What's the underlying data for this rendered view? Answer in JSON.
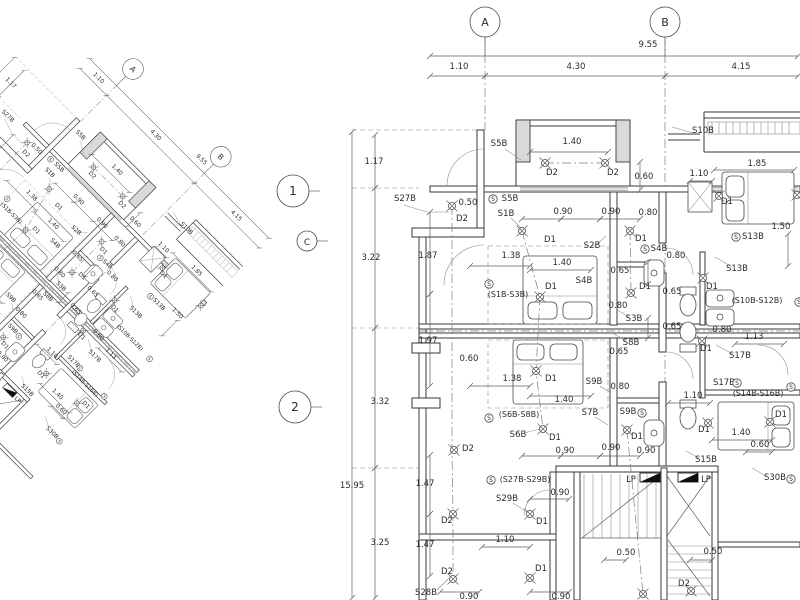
{
  "sheet": {
    "background": "#ffffff",
    "line_color": "#3a3a3a",
    "thin_color": "#8e8e8e",
    "text_color": "#2b2b2b",
    "panel_fill": "#0e0e0e"
  },
  "grid_bubbles": [
    {
      "label": "A",
      "x": 485,
      "y": 22,
      "r": 15
    },
    {
      "label": "B",
      "x": 665,
      "y": 22,
      "r": 15
    }
  ],
  "row_bubbles": [
    {
      "label": "1",
      "x": 293,
      "y": 191,
      "r": 16
    },
    {
      "label": "C",
      "x": 307,
      "y": 241,
      "r": 10
    },
    {
      "label": "2",
      "x": 295,
      "y": 407,
      "r": 16
    }
  ],
  "annotations": [
    {
      "t": "9.55",
      "x": 648,
      "y": 47
    },
    {
      "t": "1.10",
      "x": 459,
      "y": 69
    },
    {
      "t": "4.30",
      "x": 576,
      "y": 69
    },
    {
      "t": "4.15",
      "x": 741,
      "y": 69
    },
    {
      "t": "1.17",
      "x": 374,
      "y": 164
    },
    {
      "t": "3.22",
      "x": 371,
      "y": 260
    },
    {
      "t": "3.32",
      "x": 380,
      "y": 404
    },
    {
      "t": "15.95",
      "x": 352,
      "y": 488
    },
    {
      "t": "3.25",
      "x": 380,
      "y": 545
    },
    {
      "t": "1.87",
      "x": 428,
      "y": 258
    },
    {
      "t": "1.97",
      "x": 428,
      "y": 343
    },
    {
      "t": "1.47",
      "x": 425,
      "y": 486
    },
    {
      "t": "1.47",
      "x": 425,
      "y": 547
    },
    {
      "t": "S27B",
      "x": 405,
      "y": 201
    },
    {
      "t": "0.50",
      "x": 468,
      "y": 205
    },
    {
      "t": "D2",
      "x": 462,
      "y": 221
    },
    {
      "t": "S5B",
      "x": 499,
      "y": 146
    },
    {
      "t": "1.40",
      "x": 572,
      "y": 144
    },
    {
      "t": "D2",
      "x": 552,
      "y": 175
    },
    {
      "t": "D2",
      "x": 613,
      "y": 175
    },
    {
      "t": "0.60",
      "x": 644,
      "y": 179
    },
    {
      "t": "S5B",
      "x": 510,
      "y": 201
    },
    {
      "t": "S1B",
      "x": 506,
      "y": 216
    },
    {
      "t": "D1",
      "x": 550,
      "y": 242
    },
    {
      "t": "0.90",
      "x": 563,
      "y": 214
    },
    {
      "t": "0.90",
      "x": 611,
      "y": 214
    },
    {
      "t": "0.80",
      "x": 648,
      "y": 215
    },
    {
      "t": "D1",
      "x": 641,
      "y": 241
    },
    {
      "t": "S2B",
      "x": 592,
      "y": 248
    },
    {
      "t": "S4B",
      "x": 659,
      "y": 251
    },
    {
      "t": "1.38",
      "x": 511,
      "y": 258
    },
    {
      "t": "1.40",
      "x": 562,
      "y": 265
    },
    {
      "t": "S10B",
      "x": 703,
      "y": 133
    },
    {
      "t": "1.85",
      "x": 757,
      "y": 166
    },
    {
      "t": "1.10",
      "x": 699,
      "y": 176
    },
    {
      "t": "D1",
      "x": 727,
      "y": 204
    },
    {
      "t": "1.50",
      "x": 781,
      "y": 229
    },
    {
      "t": "S13B",
      "x": 753,
      "y": 239
    },
    {
      "t": "S13B",
      "x": 737,
      "y": 271
    },
    {
      "t": "D1",
      "x": 712,
      "y": 289
    },
    {
      "t": "0.80",
      "x": 676,
      "y": 258
    },
    {
      "t": "0.65",
      "x": 672,
      "y": 294
    },
    {
      "t": "0.65",
      "x": 672,
      "y": 329
    },
    {
      "t": "(S10B-S12B)",
      "x": 757,
      "y": 303
    },
    {
      "t": "0.80",
      "x": 722,
      "y": 332
    },
    {
      "t": "1.13",
      "x": 754,
      "y": 339
    },
    {
      "t": "(S1B-S3B)",
      "x": 508,
      "y": 297
    },
    {
      "t": "D1",
      "x": 551,
      "y": 289
    },
    {
      "t": "S4B",
      "x": 584,
      "y": 283
    },
    {
      "t": "0.65",
      "x": 620,
      "y": 273
    },
    {
      "t": "D1",
      "x": 645,
      "y": 289
    },
    {
      "t": "0.80",
      "x": 618,
      "y": 308
    },
    {
      "t": "S3B",
      "x": 634,
      "y": 321
    },
    {
      "t": "S8B",
      "x": 631,
      "y": 345
    },
    {
      "t": "0.65",
      "x": 619,
      "y": 354
    },
    {
      "t": "0.60",
      "x": 469,
      "y": 361
    },
    {
      "t": "1.38",
      "x": 512,
      "y": 381
    },
    {
      "t": "D1",
      "x": 551,
      "y": 381
    },
    {
      "t": "S9B",
      "x": 594,
      "y": 384
    },
    {
      "t": "0.80",
      "x": 620,
      "y": 389
    },
    {
      "t": "1.40",
      "x": 564,
      "y": 402
    },
    {
      "t": "D1",
      "x": 706,
      "y": 351
    },
    {
      "t": "S17B",
      "x": 740,
      "y": 358
    },
    {
      "t": "S17B",
      "x": 724,
      "y": 385
    },
    {
      "t": "(S14B-S16B)",
      "x": 758,
      "y": 396
    },
    {
      "t": "1.10",
      "x": 693,
      "y": 398
    },
    {
      "t": "D1",
      "x": 781,
      "y": 417
    },
    {
      "t": "D1",
      "x": 704,
      "y": 432
    },
    {
      "t": "1.40",
      "x": 741,
      "y": 435
    },
    {
      "t": "0.60",
      "x": 760,
      "y": 447
    },
    {
      "t": "S15B",
      "x": 706,
      "y": 462
    },
    {
      "t": "S30B",
      "x": 775,
      "y": 480
    },
    {
      "t": "(S6B-S8B)",
      "x": 519,
      "y": 417
    },
    {
      "t": "S6B",
      "x": 518,
      "y": 437
    },
    {
      "t": "D1",
      "x": 555,
      "y": 440
    },
    {
      "t": "S7B",
      "x": 590,
      "y": 415
    },
    {
      "t": "S9B",
      "x": 628,
      "y": 414
    },
    {
      "t": "D1",
      "x": 637,
      "y": 439
    },
    {
      "t": "D2",
      "x": 468,
      "y": 451
    },
    {
      "t": "0.90",
      "x": 565,
      "y": 453
    },
    {
      "t": "0.90",
      "x": 611,
      "y": 450
    },
    {
      "t": "0.90",
      "x": 646,
      "y": 453
    },
    {
      "t": "(S27B-S29B)",
      "x": 525,
      "y": 482
    },
    {
      "t": "LP",
      "x": 631,
      "y": 482
    },
    {
      "t": "LP",
      "x": 706,
      "y": 482
    },
    {
      "t": "0.90",
      "x": 560,
      "y": 495
    },
    {
      "t": "S29B",
      "x": 507,
      "y": 501
    },
    {
      "t": "D1",
      "x": 542,
      "y": 524
    },
    {
      "t": "1.10",
      "x": 505,
      "y": 542
    },
    {
      "t": "D2",
      "x": 447,
      "y": 523
    },
    {
      "t": "D2",
      "x": 447,
      "y": 574
    },
    {
      "t": "D1",
      "x": 541,
      "y": 571
    },
    {
      "t": "S28B",
      "x": 426,
      "y": 595
    },
    {
      "t": "0.90",
      "x": 469,
      "y": 599
    },
    {
      "t": "0.90",
      "x": 561,
      "y": 599
    },
    {
      "t": "0.50",
      "x": 626,
      "y": 555
    },
    {
      "t": "0.50",
      "x": 713,
      "y": 554
    },
    {
      "t": "D2",
      "x": 684,
      "y": 586
    }
  ],
  "switch_symbols": [
    [
      493,
      199
    ],
    [
      645,
      249
    ],
    [
      489,
      284
    ],
    [
      736,
      237
    ],
    [
      489,
      418
    ],
    [
      642,
      413
    ],
    [
      491,
      480
    ],
    [
      737,
      383
    ],
    [
      791,
      387
    ],
    [
      791,
      479
    ],
    [
      799,
      302
    ]
  ],
  "light_symbols": [
    [
      452,
      206
    ],
    [
      545,
      163
    ],
    [
      605,
      163
    ],
    [
      522,
      231
    ],
    [
      630,
      231
    ],
    [
      540,
      297
    ],
    [
      631,
      293
    ],
    [
      536,
      371
    ],
    [
      543,
      429
    ],
    [
      627,
      430
    ],
    [
      454,
      450
    ],
    [
      453,
      514
    ],
    [
      530,
      514
    ],
    [
      453,
      579
    ],
    [
      530,
      578
    ],
    [
      643,
      594
    ],
    [
      691,
      591
    ],
    [
      719,
      196
    ],
    [
      797,
      195
    ],
    [
      703,
      278
    ],
    [
      702,
      341
    ],
    [
      708,
      423
    ],
    [
      770,
      422
    ]
  ],
  "dim_lines": [
    [
      430,
      56,
      798,
      56
    ],
    [
      430,
      76,
      485,
      76
    ],
    [
      485,
      76,
      665,
      76
    ],
    [
      665,
      76,
      798,
      76
    ],
    [
      375,
      135,
      375,
      188
    ],
    [
      375,
      188,
      375,
      328
    ],
    [
      375,
      328,
      375,
      468
    ],
    [
      375,
      468,
      375,
      598
    ],
    [
      352,
      132,
      352,
      598
    ],
    [
      430,
      212,
      430,
      294
    ],
    [
      430,
      294,
      430,
      386
    ],
    [
      430,
      455,
      430,
      514
    ],
    [
      430,
      514,
      430,
      576
    ],
    [
      530,
      152,
      608,
      152
    ],
    [
      640,
      162,
      640,
      190
    ],
    [
      522,
      219,
      561,
      219
    ],
    [
      561,
      219,
      600,
      219
    ],
    [
      600,
      219,
      640,
      219
    ],
    [
      470,
      266,
      530,
      266
    ],
    [
      530,
      270,
      591,
      270
    ],
    [
      470,
      386,
      530,
      386
    ],
    [
      530,
      396,
      591,
      396
    ],
    [
      522,
      456,
      561,
      456
    ],
    [
      561,
      456,
      600,
      456
    ],
    [
      600,
      456,
      640,
      456
    ],
    [
      714,
      170,
      794,
      170
    ],
    [
      690,
      181,
      712,
      181
    ],
    [
      788,
      234,
      788,
      266
    ],
    [
      648,
      262,
      648,
      284
    ],
    [
      648,
      318,
      648,
      338
    ],
    [
      735,
      344,
      784,
      344
    ],
    [
      668,
      403,
      710,
      403
    ],
    [
      712,
      440,
      772,
      440
    ],
    [
      746,
      452,
      772,
      452
    ],
    [
      530,
      499,
      569,
      499
    ],
    [
      482,
      547,
      530,
      547
    ],
    [
      604,
      560,
      626,
      560
    ],
    [
      690,
      560,
      712,
      560
    ],
    [
      440,
      592,
      479,
      592
    ],
    [
      530,
      592,
      569,
      592
    ]
  ],
  "leaders": [
    [
      404,
      205,
      427,
      212,
      449,
      212
    ],
    [
      505,
      149,
      521,
      160
    ],
    [
      693,
      133,
      672,
      127
    ],
    [
      511,
      218,
      521,
      228
    ],
    [
      597,
      244,
      606,
      236
    ],
    [
      629,
      317,
      616,
      309
    ],
    [
      626,
      341,
      614,
      334
    ],
    [
      600,
      386,
      611,
      393
    ],
    [
      732,
      267,
      715,
      257
    ],
    [
      733,
      354,
      716,
      345
    ],
    [
      699,
      458,
      686,
      451
    ],
    [
      524,
      433,
      540,
      429
    ],
    [
      595,
      417,
      608,
      425
    ],
    [
      513,
      503,
      527,
      512
    ],
    [
      437,
      590,
      449,
      578
    ],
    [
      766,
      476,
      752,
      468
    ]
  ]
}
